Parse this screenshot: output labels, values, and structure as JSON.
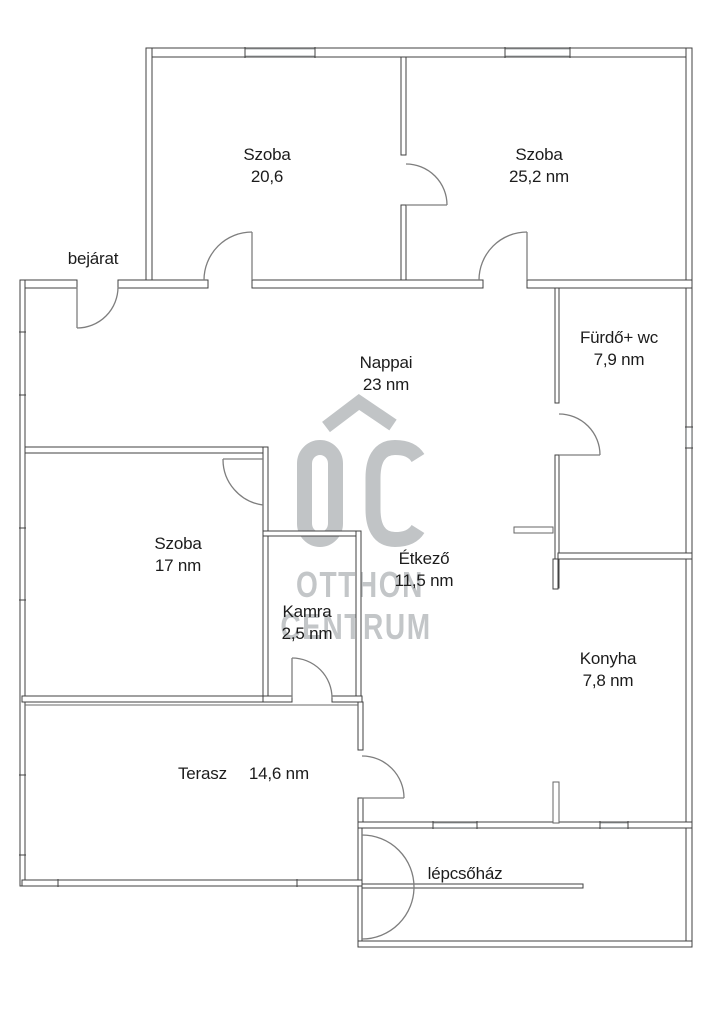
{
  "watermark": {
    "logo": "OC",
    "line1": "OTTHON",
    "line2": "CENTRUM",
    "color": "#c1c4c6"
  },
  "colors": {
    "wall_line": "#414141",
    "window_line": "#a9adaf",
    "door_line": "#7e7e7e",
    "label_text": "#1c1c1c",
    "background": "#ffffff"
  },
  "rooms": [
    {
      "id": "szoba-20",
      "name": "Szoba",
      "area": "20,6"
    },
    {
      "id": "szoba-25",
      "name": "Szoba",
      "area": "25,2 nm"
    },
    {
      "id": "bejarat",
      "name": "bejárat",
      "area": ""
    },
    {
      "id": "nappali",
      "name": "Nappai",
      "area": "23 nm"
    },
    {
      "id": "furdo-wc",
      "name": "Fürdő+ wc",
      "area": "7,9 nm"
    },
    {
      "id": "szoba-17",
      "name": "Szoba",
      "area": "17 nm"
    },
    {
      "id": "etkezo",
      "name": "Étkező",
      "area": "11,5 nm"
    },
    {
      "id": "kamra",
      "name": "Kamra",
      "area": "2,5 nm"
    },
    {
      "id": "konyha",
      "name": "Konyha",
      "area": "7,8 nm"
    },
    {
      "id": "terasz",
      "name": "Terasz",
      "area": "14,6 nm"
    },
    {
      "id": "lepcsohaz",
      "name": "lépcsőház",
      "area": ""
    }
  ]
}
